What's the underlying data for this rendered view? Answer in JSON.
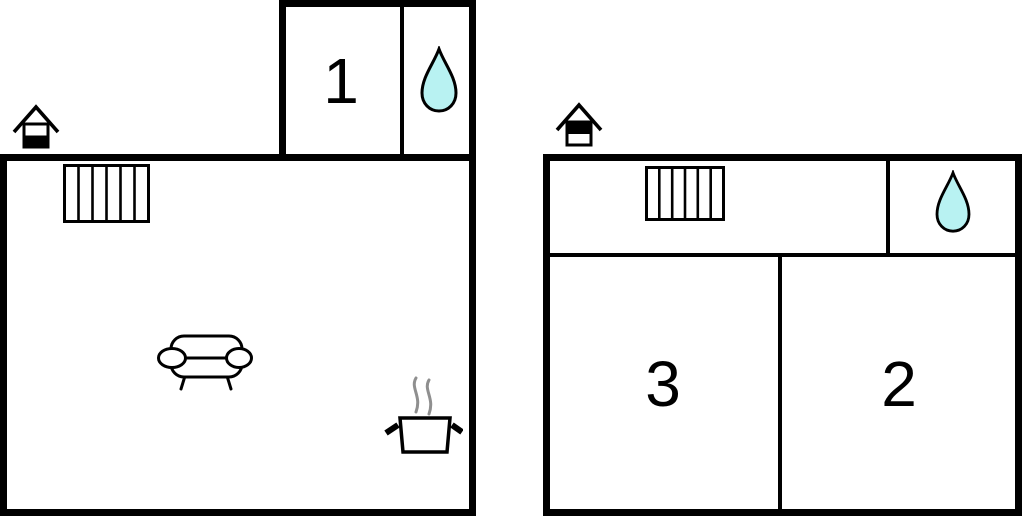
{
  "canvas": {
    "width": 1024,
    "height": 517,
    "background": "#ffffff"
  },
  "colors": {
    "wall": "#000000",
    "water_drop_fill": "#b8f2f2",
    "steam": "#8f8f8f",
    "room_label": "#000000"
  },
  "floor_plans": [
    {
      "name": "left-unit",
      "floor_indicator_icon": "house-lower-half-filled-icon",
      "room_labels": [
        "1"
      ],
      "feature_icons": [
        "stairs-icon",
        "water-drop-icon",
        "sofa-icon",
        "cooking-pot-icon"
      ]
    },
    {
      "name": "right-unit",
      "floor_indicator_icon": "house-upper-half-filled-icon",
      "room_labels": [
        "3",
        "2"
      ],
      "feature_icons": [
        "stairs-icon",
        "water-drop-icon"
      ]
    }
  ]
}
